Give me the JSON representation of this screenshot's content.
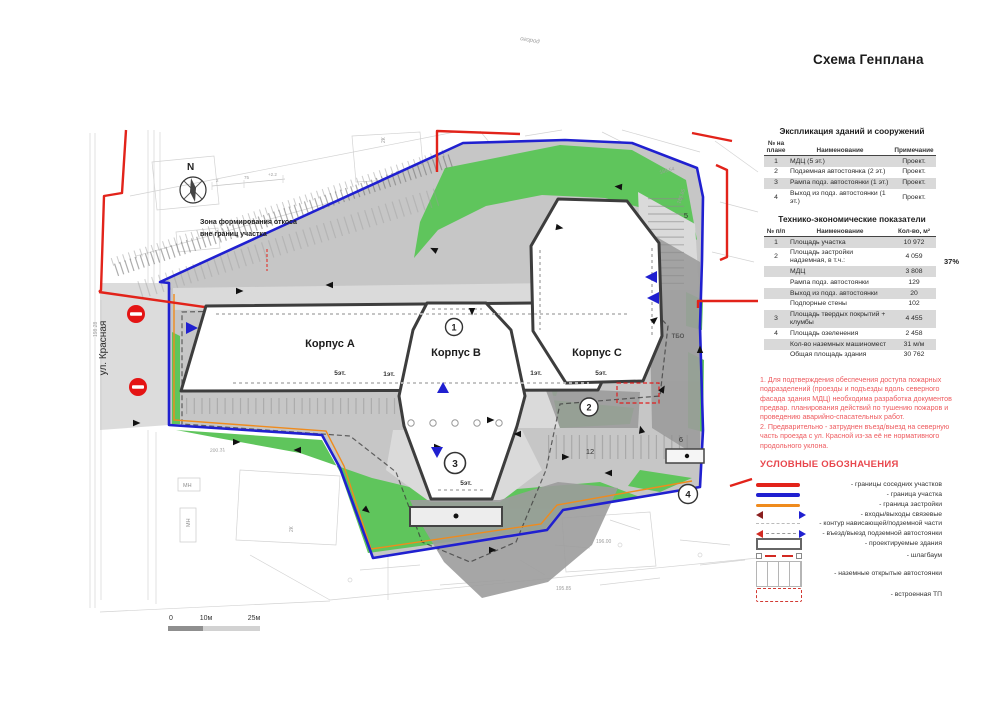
{
  "title": "Схема Генплана",
  "explication": {
    "title": "Экспликация зданий и сооружений",
    "headers": {
      "num": "№ на плане",
      "name": "Наименование",
      "note": "Примечание"
    },
    "rows": [
      {
        "num": "1",
        "name": "МДЦ (5 эт.)",
        "note": "Проект."
      },
      {
        "num": "2",
        "name": "Подземная автостоянка (2 эт.)",
        "note": "Проект."
      },
      {
        "num": "3",
        "name": "Рампа подз. автостоянки (1 эт.)",
        "note": "Проект."
      },
      {
        "num": "4",
        "name": "Выход из подз. автостоянки (1 эт.)",
        "note": "Проект."
      }
    ]
  },
  "indicators": {
    "title": "Технико-экономические показатели",
    "headers": {
      "num": "№ п/п",
      "name": "Наименование",
      "qty": "Кол-во, м²"
    },
    "percent_note": "37%",
    "rows": [
      {
        "num": "1",
        "name": "Площадь участка",
        "qty": "10 972"
      },
      {
        "num": "2",
        "name": "Площадь застройки надземная, в т.ч.:",
        "qty": "4 059"
      },
      {
        "num": "",
        "name": "МДЦ",
        "qty": "3 808"
      },
      {
        "num": "",
        "name": "Рампа подз. автостоянки",
        "qty": "129"
      },
      {
        "num": "",
        "name": "Выход из подз. автостоянки",
        "qty": "20"
      },
      {
        "num": "",
        "name": "Подпорные стены",
        "qty": "102"
      },
      {
        "num": "3",
        "name": "Площадь твердых покрытий + клумбы",
        "qty": "4 455"
      },
      {
        "num": "4",
        "name": "Площадь озеленения",
        "qty": "2 458"
      },
      {
        "num": "",
        "name": "Кол-во наземных машиномест",
        "qty": "31 м/м"
      },
      {
        "num": "",
        "name": "Общая площадь здания",
        "qty": "30 762"
      }
    ]
  },
  "notes": {
    "note1": "1. Для подтверждения обеспечения доступа пожарных подразделений (проезды и подъезды вдоль северного фасада здания МДЦ) необходима разработка документов предвар. планирования действий по тушению пожаров и проведению аварийно-спасательных работ.",
    "note2": "2. Предварительно - затруднен въезд/выезд на северную часть проезда с ул. Красной из-за её не нормативного продольного уклона."
  },
  "legend": {
    "title": "УСЛОВНЫЕ ОБОЗНАЧЕНИЯ",
    "items": [
      {
        "label": "- границы соседних участков"
      },
      {
        "label": "- граница участка"
      },
      {
        "label": "- граница застройки"
      },
      {
        "label": "- входы/выходы связевые"
      },
      {
        "label": "- контур нависающей/подземной части"
      },
      {
        "label": "- въезд/выезд подземной автостоянки"
      },
      {
        "label": "- проектируемые здания"
      },
      {
        "label": "- шлагбаум"
      },
      {
        "label": "- наземные открытые автостоянки"
      },
      {
        "label": "- встроенная ТП"
      }
    ]
  },
  "plan": {
    "north": "N",
    "street": "ул. Красная",
    "slope_zone_line1": "Зона формирования откоса",
    "slope_zone_line2": "вне границ участка",
    "building_a": "Корпус A",
    "building_b": "Корпус B",
    "building_c": "Корпус C",
    "floors_5": "5эт.",
    "floors_1": "1эт.",
    "marker_1": "1",
    "marker_2": "2",
    "marker_3": "3",
    "marker_4": "4",
    "num_5": "5",
    "num_6": "6",
    "num_12": "12",
    "tbo": "ТБО",
    "scale_0": "0",
    "scale_10": "10м",
    "scale_25": "25м",
    "survey": {
      "s1": "2К",
      "s2": "2К",
      "s3": "МН",
      "s4": "МН",
      "s5": "огород",
      "s6": "185.54",
      "s7": "185.85",
      "s8": "196.00",
      "s9": "195.85",
      "s10": "198.28",
      "s11": "200.31",
      "s12": "2",
      "s13": "75",
      "s14": "+2.2"
    }
  },
  "colors": {
    "boundary_red": "#e2231a",
    "boundary_blue": "#2020d0",
    "build_line_orange": "#ef8b1d",
    "green": "#5fc55c",
    "note_red": "#ee5a5e"
  }
}
